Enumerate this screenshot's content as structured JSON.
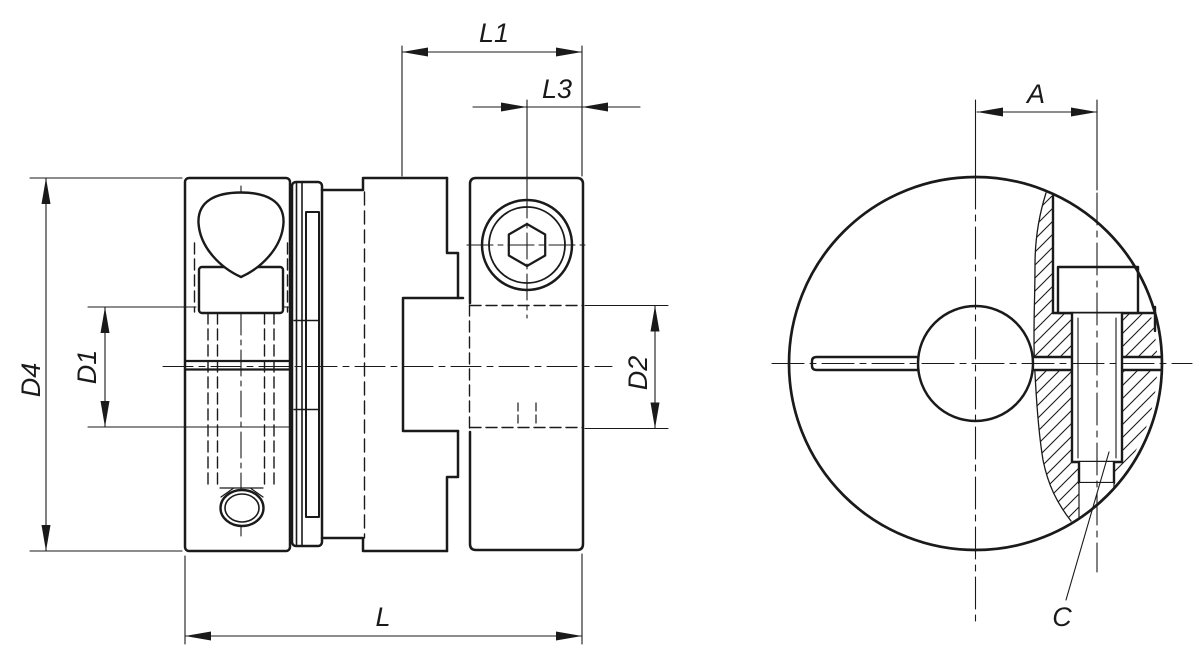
{
  "page": {
    "background": "#ffffff",
    "line_color": "#1a1a1a",
    "description": "Technical drawing of a shaft coupling with clamping hubs: side section view and front view with local section through clamping screw"
  },
  "dimensions": {
    "L1": "L1",
    "L3": "L3",
    "L": "L",
    "A": "A",
    "C": "C",
    "D1": "D1",
    "D2": "D2",
    "D4": "D4"
  }
}
